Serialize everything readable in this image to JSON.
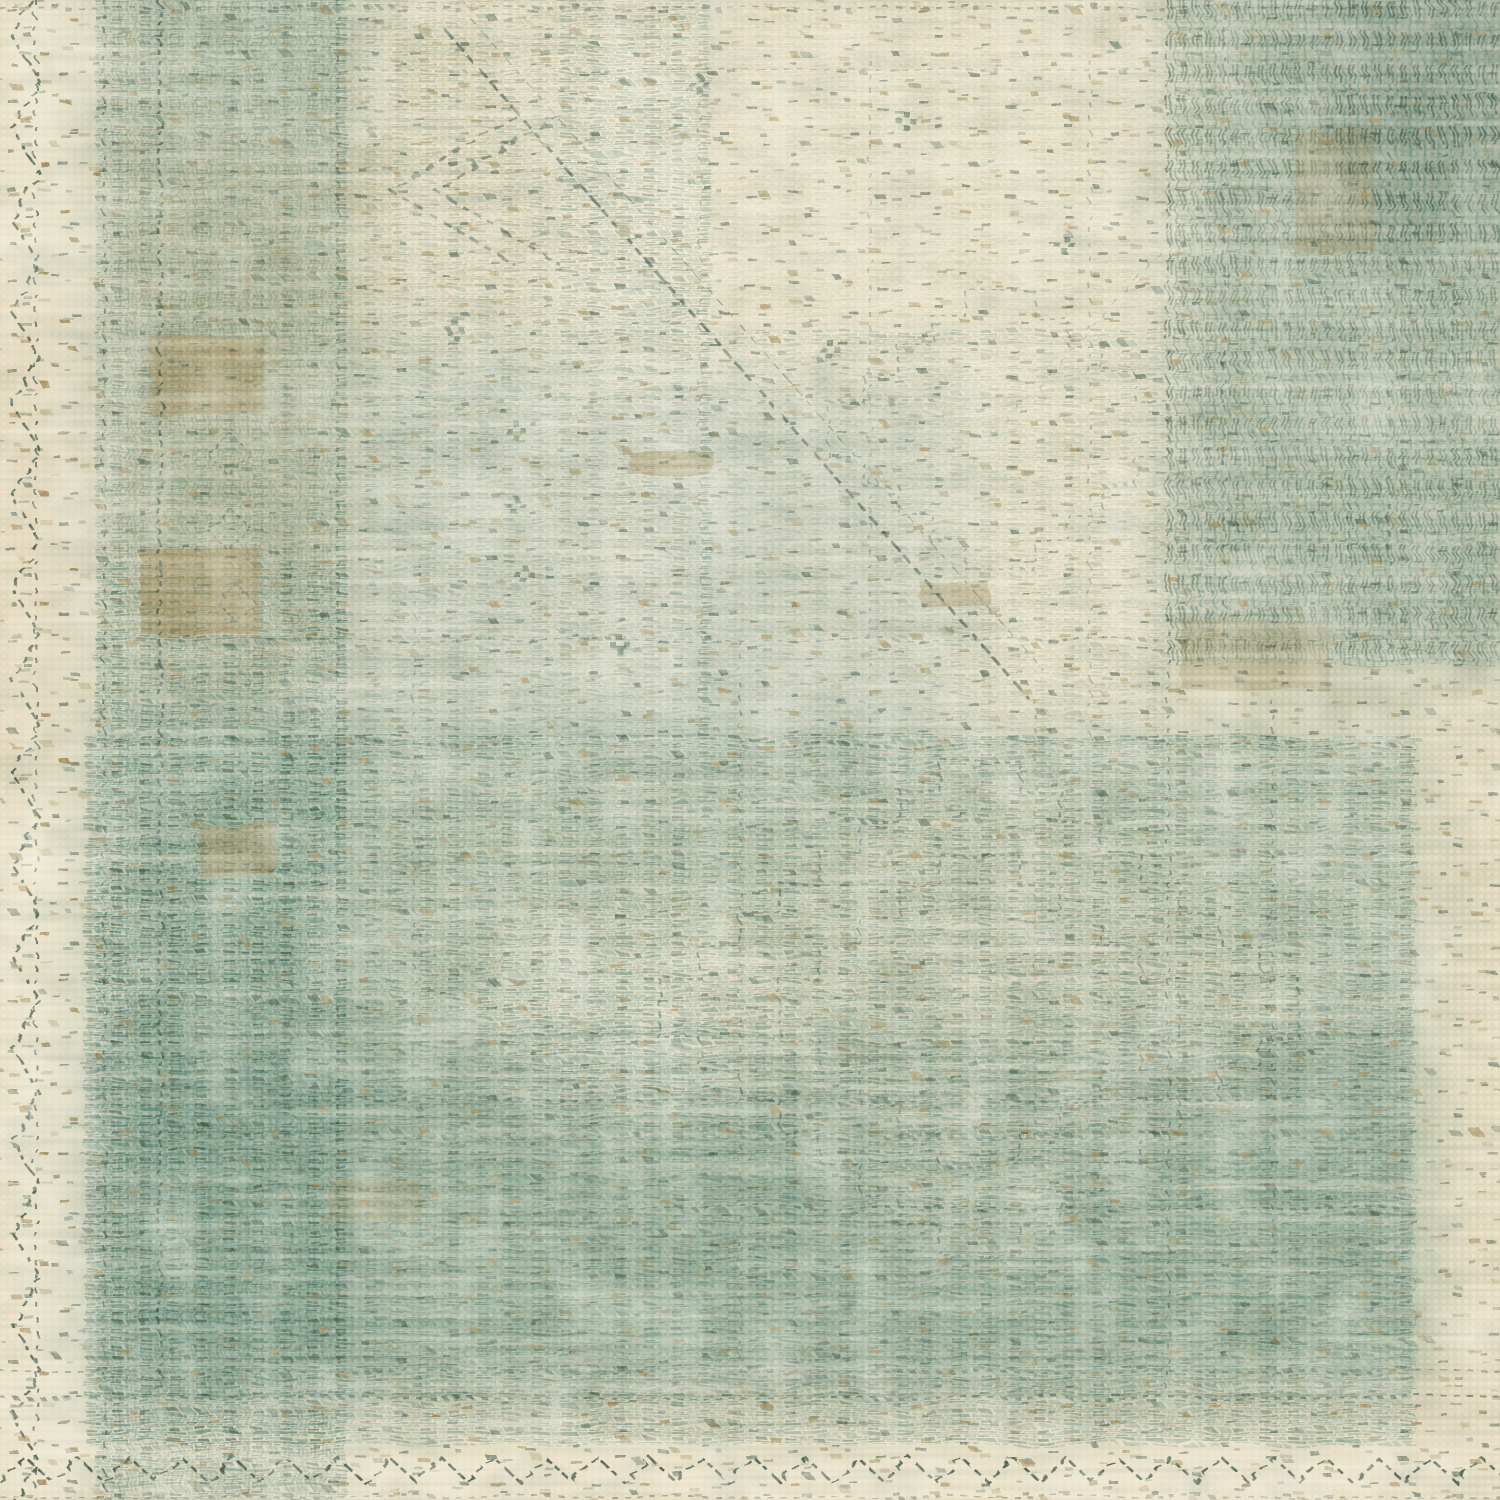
{
  "image": {
    "type": "photograph",
    "subject": "Close-up corner detail of a vintage-style woven area rug",
    "description": "Distressed flat-woven rug in seafoam and teal green over a cream and beige ground. Faded geometric oriental medallion pattern, vertical striped border band on the left, dense motif block in the upper right, horizontal teal thread striping across the lower half, dotted weave texture throughout, and dark dashed zigzag stitching along the left and bottom edges.",
    "alt": "Faded cream and seafoam-green woven rug texture with distressed geometric pattern and zigzag stitched border"
  },
  "palette": {
    "cream": "#e4dabe",
    "cream_light": "#f2ebd6",
    "cream_dark": "#cfc2a0",
    "tan": "#c2ae85",
    "tan_deep": "#a18a58",
    "teal": "#5f8a7a",
    "teal_light": "#8aa897",
    "teal_pale": "#bccabe",
    "teal_deep": "#41604f",
    "teal_dark": "#33544a",
    "stitch": "#3c5449"
  }
}
